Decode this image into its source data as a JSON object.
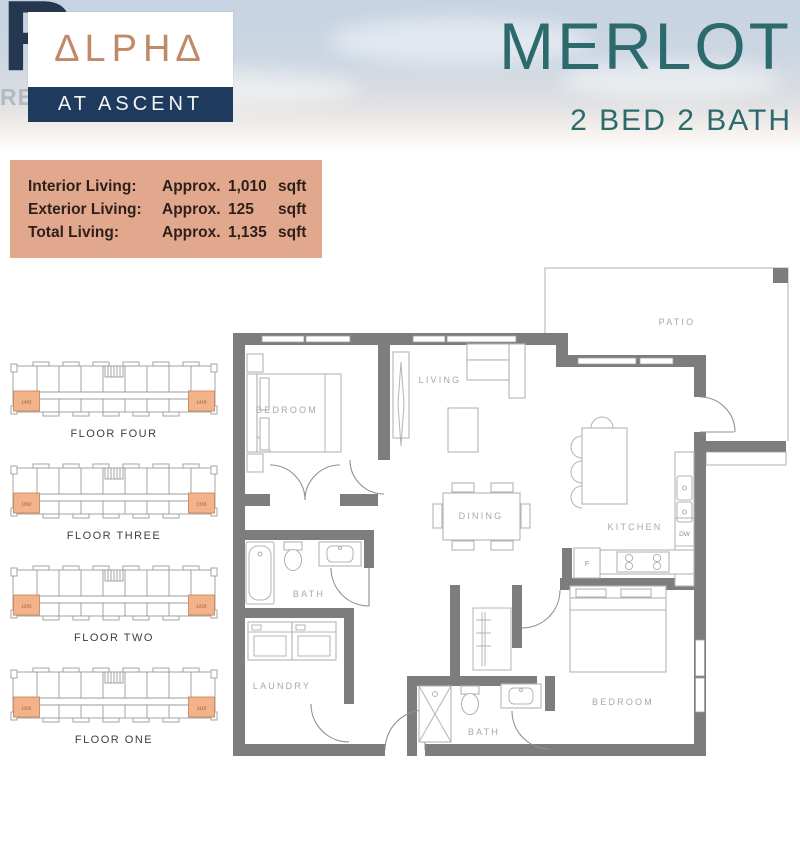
{
  "header": {
    "plan_name": "MERLOT",
    "plan_spec": "2 BED 2 BATH",
    "logo": {
      "realtor_letter": "R",
      "realtor_word": "REALTOR®",
      "brand_name": "∆LPH∆",
      "brand_sub": "AT ASCENT"
    }
  },
  "stats": {
    "rows": [
      {
        "label": "Interior Living:",
        "approx": "Approx.",
        "num": "1,010",
        "unit": "sqft"
      },
      {
        "label": "Exterior Living:",
        "approx": "Approx.",
        "num": "125",
        "unit": "sqft"
      },
      {
        "label": "Total Living:",
        "approx": "Approx.",
        "num": "1,135",
        "unit": "sqft"
      }
    ]
  },
  "floors": [
    {
      "label": "FLOOR FOUR",
      "left_unit": "1402",
      "right_unit": "1416"
    },
    {
      "label": "FLOOR THREE",
      "left_unit": "1302",
      "right_unit": "1316"
    },
    {
      "label": "FLOOR TWO",
      "left_unit": "1202",
      "right_unit": "1216"
    },
    {
      "label": "FLOOR ONE",
      "left_unit": "1102",
      "right_unit": "1116"
    }
  ],
  "floorplan": {
    "labels": {
      "bedroom1": "BEDROOM",
      "living": "LIVING",
      "patio": "PATIO",
      "dining": "DINING",
      "kitchen": "KITCHEN",
      "bath1": "BATH",
      "laundry": "LAUNDRY",
      "bath2": "BATH",
      "bedroom2": "BEDROOM",
      "fridge": "F",
      "dishwasher": "DW"
    }
  },
  "colors": {
    "accent_teal": "#2c6a6e",
    "stats_salmon": "#e2a88d",
    "brand_navy": "#1e3a5d",
    "brand_copper": "#c08a68",
    "wall_gray": "#7d7d7d",
    "unit_highlight": "#f2b28a"
  }
}
